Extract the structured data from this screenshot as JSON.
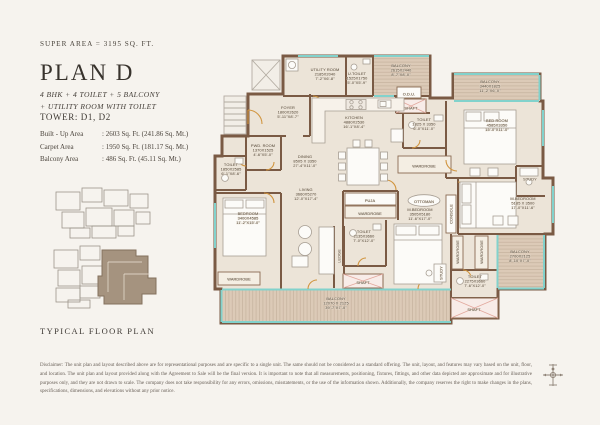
{
  "header": {
    "super_area": "SUPER AREA = 3195 SQ. FT.",
    "plan_title": "PLAN D",
    "subtitle_line1": "4 BHK + 4 TOILET + 5 BALCONY",
    "subtitle_line2": "+ UTILITY ROOM WITH TOILET",
    "tower": "TOWER: D1, D2"
  },
  "areas": [
    {
      "label": "Built - Up Area",
      "value": ": 2603 Sq. Ft. (241.86 Sq. Mt.)"
    },
    {
      "label": "Carpet Area",
      "value": ": 1950 Sq. Ft. (181.17 Sq. Mt.)"
    },
    {
      "label": "Balcony Area",
      "value": ": 486 Sq. Ft. (45.11 Sq. Mt.)"
    }
  ],
  "key_plan": {
    "caption": "TYPICAL FLOOR PLAN"
  },
  "footer": {
    "disclaimer": "Disclaimer: The unit plan and layout described above are for representational purposes and are specific to a single unit. The same should not be considered as a standard offering. The unit, layout, and features may vary based on the unit, floor, and location. The unit plan and layout provided along with the Agreement to Sale will be the final version. It is important to note that all measurements, positioning, fixtures, fittings, and other data depicted are approximate and for illustrative purposes only, and they are not drawn to scale. The company does not take responsibility for any errors, omissions, misstatements, or the use of the information shown. Additionally, the company reserves the right to make changes in the plans, specifications, dimensions, and elevations without any prior notice."
  },
  "colors": {
    "wall": "#7a5a44",
    "glass": "#82d2cc",
    "floor": "#ece4d8",
    "deck": "#dccab7",
    "shaft": "#f8ece8",
    "highlight": "#a5937f"
  },
  "floor_plan": {
    "rooms": [
      {
        "label": "UTILITY ROOM",
        "dims": "2185X2040",
        "ft": "7'-2\"X6'-8\"",
        "x": 117,
        "y": 26
      },
      {
        "label": "U.TOILET",
        "dims": "1525X1750",
        "ft": "5'-0\"X5'-9\"",
        "x": 149,
        "y": 30
      },
      {
        "label": "BALCONY",
        "dims": "2615X2440",
        "ft": "8'-7\"X8'-0\"",
        "x": 193,
        "y": 22
      },
      {
        "label": "O.D.U.",
        "x": 201,
        "y": 46
      },
      {
        "label": "SHAFT",
        "x": 203,
        "y": 60
      },
      {
        "label": "BALCONY",
        "dims": "3440X1825",
        "ft": "11'-2\"X6'-0\"",
        "x": 282,
        "y": 38
      },
      {
        "label": "FOYER",
        "dims": "1800X2620",
        "ft": "5'-11\"X8'-7\"",
        "x": 80,
        "y": 64
      },
      {
        "label": "KITCHEN",
        "dims": "4880X2530",
        "ft": "16'-1\"X8'-4\"",
        "x": 146,
        "y": 74
      },
      {
        "label": "TOILET",
        "dims": "1825 X 3350",
        "ft": "6'-0\"X11'-0\"",
        "x": 216,
        "y": 76
      },
      {
        "label": "BED ROOM",
        "dims": "4585X3350",
        "ft": "15'-0\"X11'-0\"",
        "x": 289,
        "y": 77
      },
      {
        "label": "STUDY",
        "x": 322,
        "y": 131
      },
      {
        "label": "PWD. ROOM",
        "dims": "1370X1525",
        "ft": "4'-6\"X5'-0\"",
        "x": 55,
        "y": 102
      },
      {
        "label": "DINING",
        "dims": "8505 X 3350",
        "ft": "27'-4\"X11'-0\"",
        "x": 97,
        "y": 113
      },
      {
        "label": "LIVING",
        "dims": "3660X5270",
        "ft": "12'-0\"X17'-4\"",
        "x": 98,
        "y": 146
      },
      {
        "label": "PUJA",
        "x": 162,
        "y": 152.5
      },
      {
        "label": "WARDROBE",
        "x": 162,
        "y": 165.5
      },
      {
        "label": "OTTOMAN",
        "x": 216,
        "y": 153.5
      },
      {
        "label": "M.BEDROOM",
        "dims": "3505X5180",
        "ft": "11'-6\"X17'-0\"",
        "x": 212,
        "y": 166
      },
      {
        "label": "CONSOLE",
        "x": 243,
        "y": 166,
        "rot": -90
      },
      {
        "label": "WARDROBE",
        "x": 216,
        "y": 118
      },
      {
        "label": "TOILET",
        "dims": "1850X2585",
        "ft": "6'-1\"X8'-6\"",
        "x": 23,
        "y": 121
      },
      {
        "label": "BEDROOM",
        "dims": "3400X4585",
        "ft": "11'-2\"X15'-0\"",
        "x": 40,
        "y": 170
      },
      {
        "label": "WARDROBE",
        "x": 31,
        "y": 231
      },
      {
        "label": "TOILET",
        "dims": "2135X3660",
        "ft": "7'-0\"X12'-0\"",
        "x": 156,
        "y": 188
      },
      {
        "label": "M.BEDROOM",
        "dims": "5185 X 3500",
        "ft": "17'-0\"X11'-6\"",
        "x": 315,
        "y": 155
      },
      {
        "label": "WARDROBE",
        "x": 249.5,
        "y": 204,
        "rot": -90
      },
      {
        "label": "WARDROBE",
        "x": 273.5,
        "y": 204,
        "rot": -90
      },
      {
        "label": "STUDY",
        "x": 233,
        "y": 225,
        "rot": -90
      },
      {
        "label": "BALCONY",
        "dims": "2700X2125",
        "ft": "8'-10\"X7'-0\"",
        "x": 312,
        "y": 208
      },
      {
        "label": "TOILET",
        "dims": "2275X3660",
        "ft": "7'-6\"X12'-0\"",
        "x": 267,
        "y": 233
      },
      {
        "label": "SHAFT",
        "x": 266,
        "y": 261.5
      },
      {
        "label": "SHAFT",
        "x": 155,
        "y": 234.5
      },
      {
        "label": "LEDGE",
        "x": 131,
        "y": 208,
        "rot": -90
      },
      {
        "label": "BALCONY",
        "dims": "12070 X 2125",
        "ft": "39'-7\"X7'-0\"",
        "x": 128,
        "y": 255
      }
    ]
  }
}
